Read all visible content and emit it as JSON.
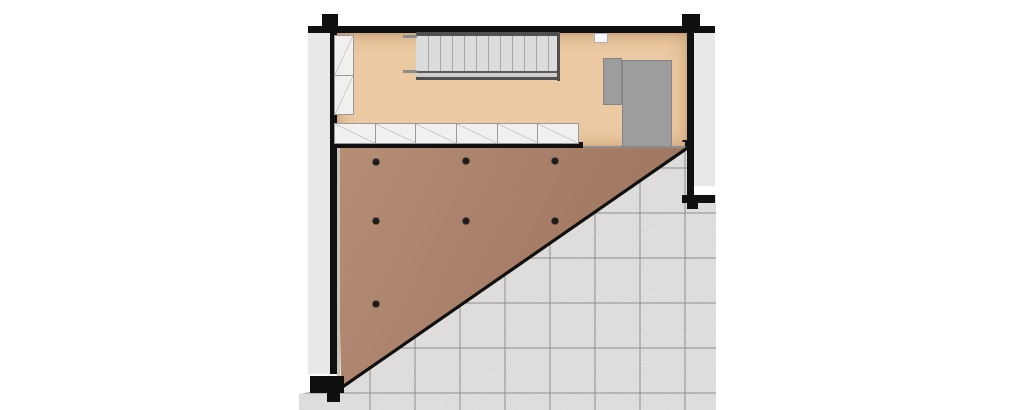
{
  "page": {
    "type": "architectural-floor-plan",
    "description": "Loft floor plan: room with staircase and storage cabinets, gray wardrobe block, triangular area under slope with ceiling spots, exterior tiled terrace"
  },
  "colors": {
    "wall": "#101010",
    "exterior_band": "#e8e8e8",
    "room_floor": "#ebc9a2",
    "slope_light": "#b68e76",
    "slope_mid": "#a87f68",
    "slope_dark": "#9a735e",
    "tile_base": "#e6e5e3",
    "tile_grid_line": "#8d8d8d",
    "furniture": "#9d9d9d",
    "cabinet_fill": "#f1f0ee",
    "cabinet_line": "#9a9a9a",
    "stair_tread": "#dcdcdc",
    "stair_rail": "#4f4f4f",
    "dot": "#1c1c1c"
  },
  "stairs": {
    "tread_count": 11
  },
  "cabinets": {
    "wall_column_cells": 2,
    "row_cells": 6
  },
  "ceiling_dots": [
    [
      376,
      162
    ],
    [
      466,
      161
    ],
    [
      555,
      161
    ],
    [
      376,
      221
    ],
    [
      466,
      221
    ],
    [
      555,
      221
    ],
    [
      376,
      304
    ]
  ],
  "tile_grid": {
    "vertical_x": [
      370,
      415,
      460,
      505,
      550,
      595,
      640,
      685
    ],
    "horizontal_y": [
      168,
      213,
      258,
      303,
      348,
      393
    ]
  },
  "diagonal": {
    "x1": 688,
    "y1": 147.5,
    "x2": 341,
    "y2": 388
  }
}
